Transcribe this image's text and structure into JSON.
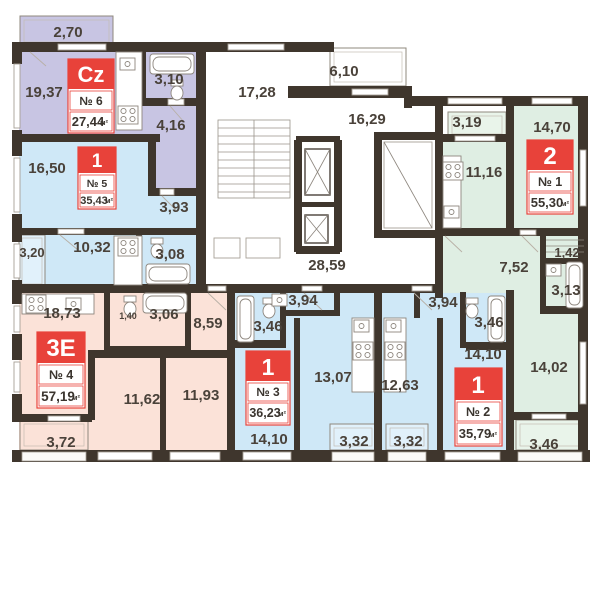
{
  "colors": {
    "accent_red": "#e8423a",
    "wall": "#3f362d",
    "unit_purple": "#c8c5e3",
    "unit_blue": "#cfe8f7",
    "balcony_blue": "#e1f1fb",
    "unit_peach": "#fbe2d8",
    "unit_green": "#dfeee3",
    "balcony_green": "#e9f4ea",
    "label_text": "#4a423a",
    "white": "#ffffff"
  },
  "units": [
    {
      "type": "Cz",
      "number": "№ 6",
      "area": "27,44",
      "area_unit": "м²",
      "rooms": [
        "2,70",
        "19,37",
        "3,10",
        "4,16"
      ]
    },
    {
      "type": "1",
      "number": "№ 5",
      "area": "35,43",
      "area_unit": "м²",
      "rooms": [
        "16,50",
        "3,93",
        "3,20",
        "10,32",
        "3,08"
      ]
    },
    {
      "type": "3E",
      "number": "№ 4",
      "area": "57,19",
      "area_unit": "м²",
      "rooms": [
        "18,73",
        "1,40",
        "3,06",
        "8,59",
        "11,62",
        "11,93",
        "3,72"
      ]
    },
    {
      "type": "1",
      "number": "№ 3",
      "area": "36,23",
      "area_unit": "м²",
      "rooms": [
        "3,94",
        "3,46",
        "13,07",
        "14,10",
        "3,32"
      ]
    },
    {
      "type": "1",
      "number": "№ 2",
      "area": "35,79",
      "area_unit": "м²",
      "rooms": [
        "3,94",
        "3,46",
        "14,10",
        "12,63",
        "3,32"
      ]
    },
    {
      "type": "2",
      "number": "№ 1",
      "area": "55,30",
      "area_unit": "м²",
      "rooms": [
        "3,19",
        "14,70",
        "11,16",
        "7,52",
        "1,42",
        "3,13",
        "14,02",
        "3,46"
      ]
    }
  ],
  "common": {
    "rooms": [
      "17,28",
      "6,10",
      "16,29",
      "28,59"
    ]
  }
}
